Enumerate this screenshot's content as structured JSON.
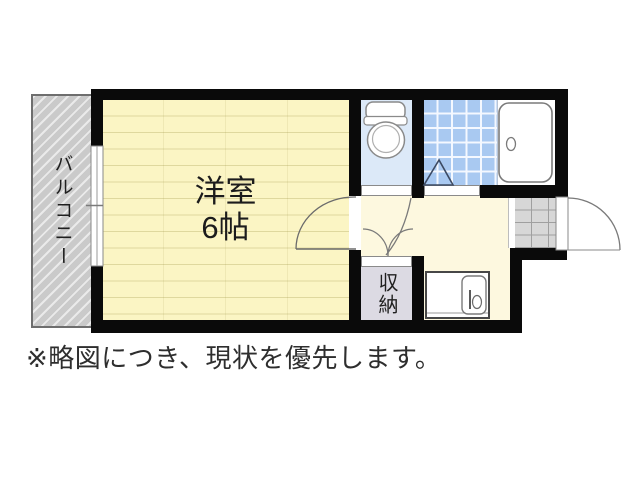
{
  "floor_plan": {
    "rooms": {
      "main_room": {
        "name": "洋室",
        "size": "6帖"
      },
      "balcony": {
        "name": "バルコニー"
      },
      "storage": {
        "name": "収納"
      }
    },
    "note": "※略図につき、現状を優先します。",
    "fixtures": {
      "toilet": "toilet-icon",
      "bathtub": "bathtub-icon",
      "shower_mark": "shower-triangle-icon",
      "kitchen_sink": "kitchen-sink-icon",
      "entrance_door": "entrance-door-swing",
      "room_door": "room-door-swing",
      "window": "sliding-window"
    },
    "colors": {
      "wall": "#0a0a0a",
      "main_room_floor": "#fbf5c4",
      "kitchen_floor": "#fdf8df",
      "balcony": "#cacaca",
      "toilet_floor": "#dce9f8",
      "bath_tile": "#a9c9f1",
      "storage_floor": "#dcdae3",
      "entrance_tile": "#d7d7d7"
    }
  }
}
